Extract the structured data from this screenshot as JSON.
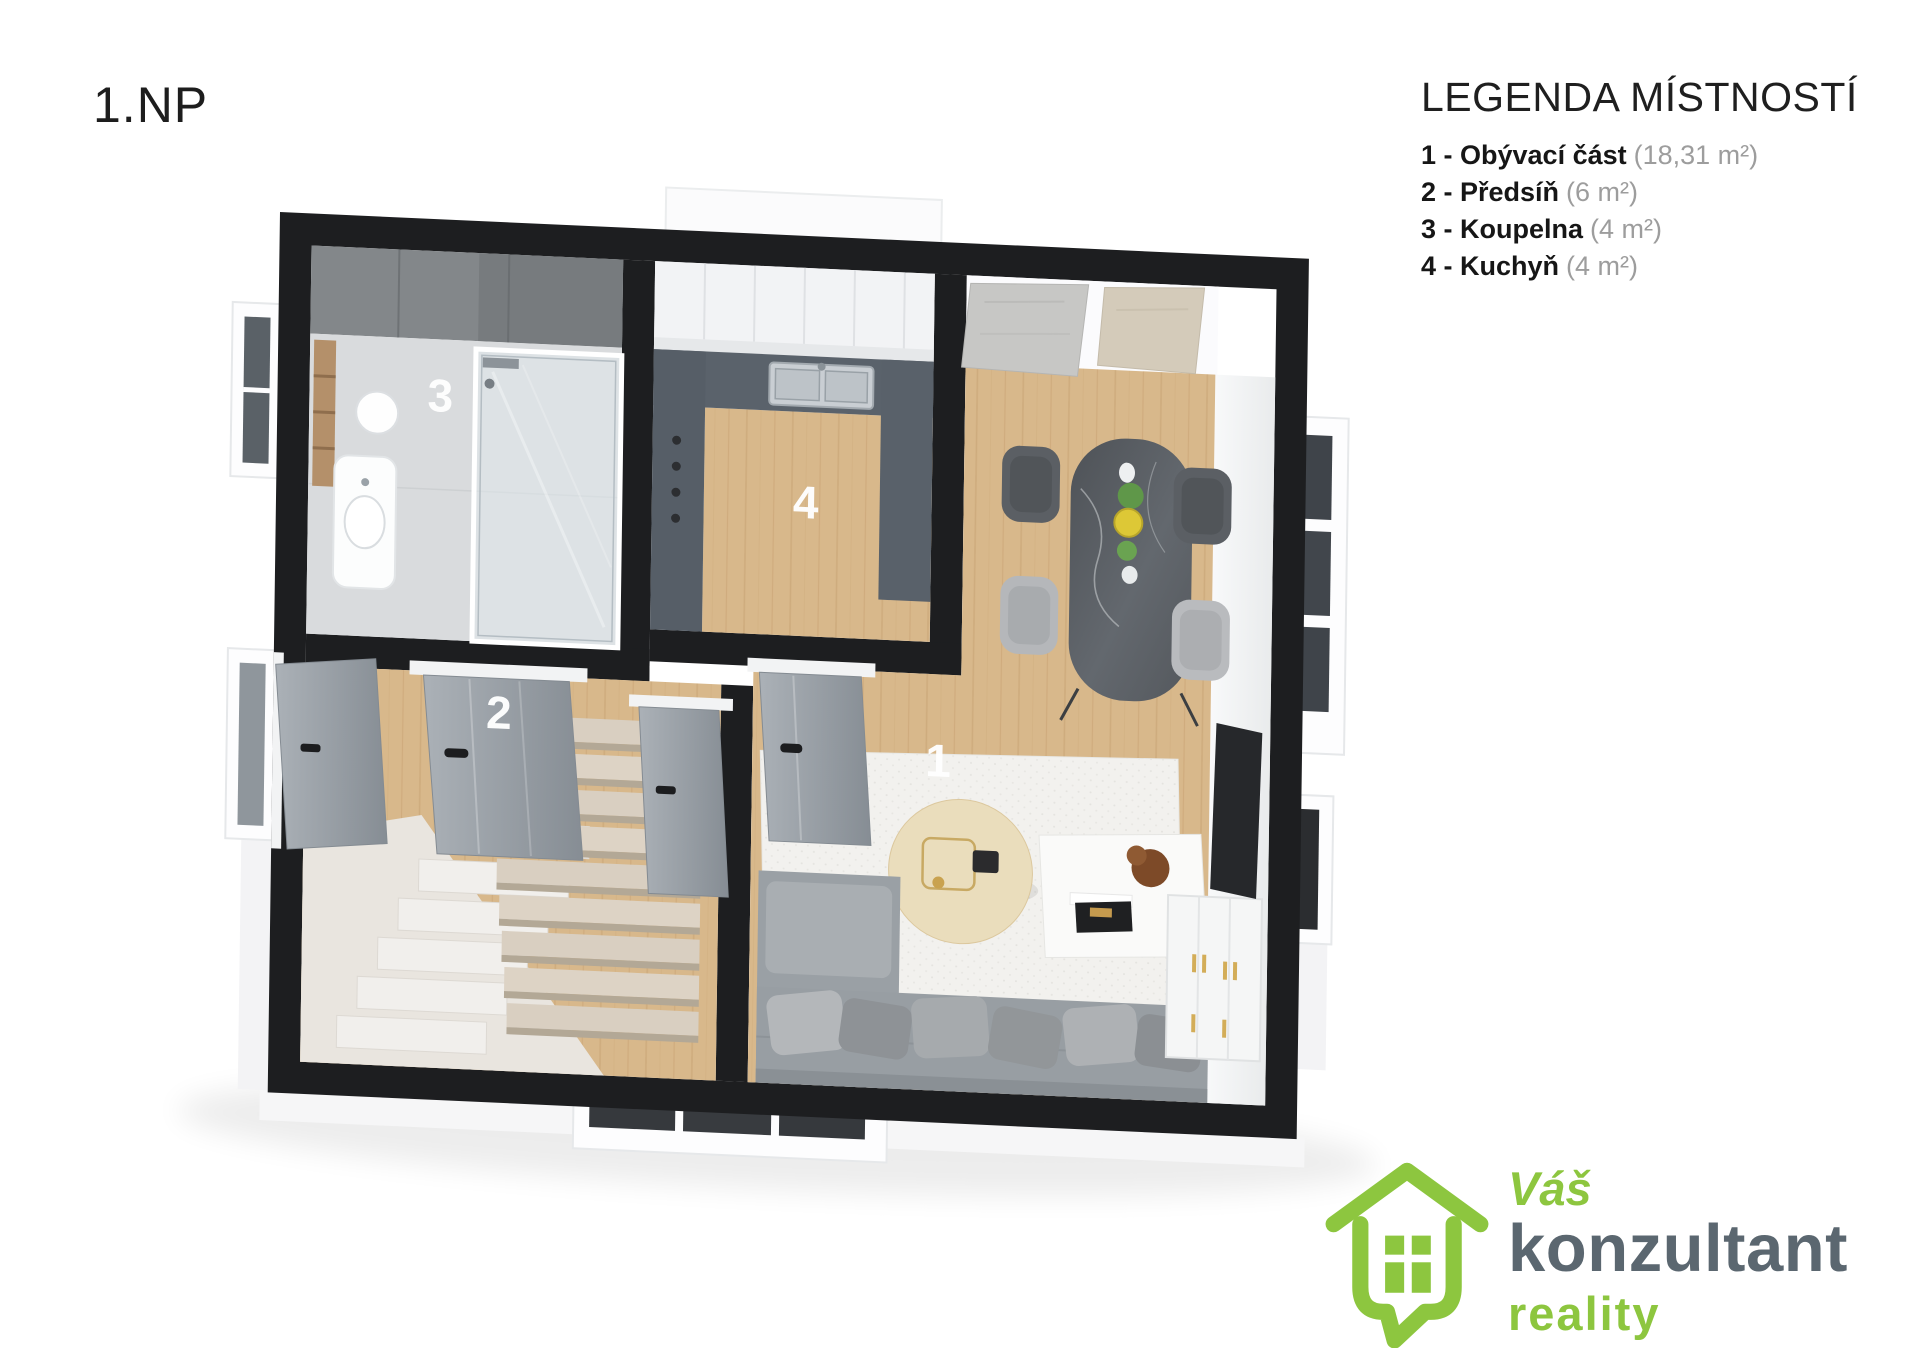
{
  "header": {
    "floor_label": "1.NP"
  },
  "legend": {
    "title": "LEGENDA MÍSTNOSTÍ",
    "items": [
      {
        "label": "1 - Obývací část",
        "area": "(18,31 m²)"
      },
      {
        "label": "2 - Předsíň",
        "area": "(6 m²)"
      },
      {
        "label": "3 - Koupelna",
        "area": "(4 m²)"
      },
      {
        "label": "4 - Kuchyň",
        "area": "(4 m²)"
      }
    ]
  },
  "plan": {
    "labels": [
      {
        "number": "1"
      },
      {
        "number": "2"
      },
      {
        "number": "3"
      },
      {
        "number": "4"
      }
    ]
  },
  "logo": {
    "word1": "Váš",
    "word2": "konzultant",
    "word3": "reality"
  },
  "colors": {
    "brand_green": "#8dc63f",
    "brand_gray": "#5b6770",
    "wall_black": "#1d1e20",
    "floor_wood": "#d8b88b",
    "bath_floor_gray": "#d9dbdd",
    "kitchen_counter": "#5a626b",
    "legend_area_gray": "#9d9d9d"
  }
}
